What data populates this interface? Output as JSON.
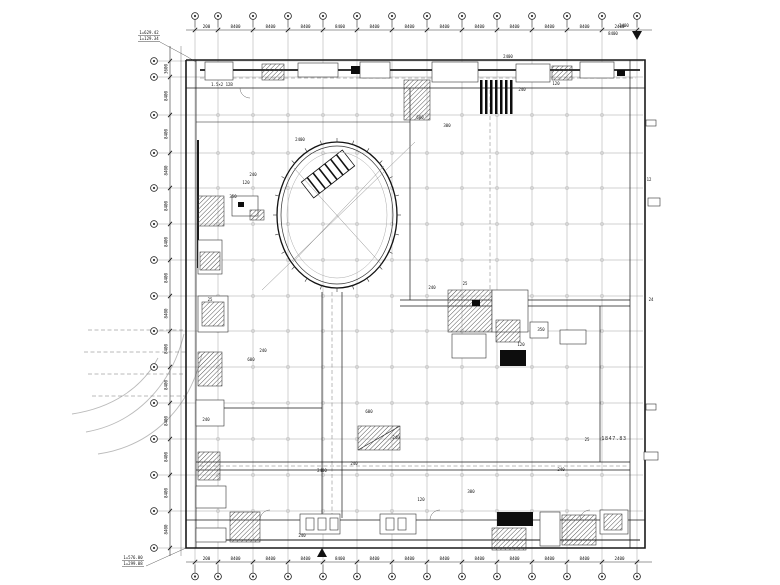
{
  "drawing": {
    "colors": {
      "background": "#ffffff",
      "line": "#111111",
      "wall": "#1a1a1a",
      "grid": "#9a9a9a",
      "dim": "#333333",
      "light": "#bbbbbb",
      "dash": "#777777"
    },
    "grid": {
      "columns_x": [
        195,
        218,
        253,
        288,
        323,
        357,
        392,
        427,
        462,
        497,
        532,
        567,
        602,
        637
      ],
      "rows_y": [
        61,
        77,
        115,
        153,
        188,
        224,
        260,
        296,
        331,
        367,
        403,
        439,
        475,
        511,
        548
      ]
    },
    "dims": {
      "top": [
        "200",
        "8400",
        "8400",
        "8400",
        "8400",
        "8400",
        "8400",
        "8400",
        "8400",
        "8400",
        "8400",
        "8400",
        "2400"
      ],
      "bottom": [
        "200",
        "8400",
        "8400",
        "8400",
        "8400",
        "8400",
        "8400",
        "8400",
        "8400",
        "8400",
        "8400",
        "8400",
        "2400"
      ],
      "left": [
        "3600",
        "8400",
        "8400",
        "8400",
        "8400",
        "8400",
        "8400",
        "8400",
        "8400",
        "8400",
        "8400",
        "8400",
        "8400",
        "8400"
      ]
    },
    "notes": {
      "top_left_line1": "1=629.42",
      "top_left_line2": "1=129.34",
      "bottom_left_line1": "1=576.00",
      "bottom_left_line2": "1=299.08",
      "right_area": "1847.83"
    },
    "atrium": {
      "cx": 337,
      "cy": 215,
      "rx": 60,
      "ry": 73
    },
    "ramp": {
      "x": 302,
      "y": 164,
      "w": 52,
      "h": 20,
      "rot": -38
    },
    "annotations": [
      [
        222,
        86,
        "1.5×2 12B"
      ],
      [
        300,
        141,
        "2400"
      ],
      [
        253,
        176,
        "240"
      ],
      [
        246,
        184,
        "120"
      ],
      [
        233,
        198,
        "350"
      ],
      [
        241,
        206,
        "25"
      ],
      [
        420,
        119,
        "600"
      ],
      [
        447,
        127,
        "300"
      ],
      [
        522,
        91,
        "240"
      ],
      [
        556,
        85,
        "120"
      ],
      [
        432,
        289,
        "240"
      ],
      [
        465,
        285,
        "25"
      ],
      [
        541,
        331,
        "350"
      ],
      [
        521,
        346,
        "120"
      ],
      [
        263,
        352,
        "240"
      ],
      [
        251,
        361,
        "600"
      ],
      [
        210,
        301,
        "25"
      ],
      [
        206,
        421,
        "240"
      ],
      [
        322,
        472,
        "2400"
      ],
      [
        354,
        465,
        "240"
      ],
      [
        421,
        501,
        "120"
      ],
      [
        471,
        493,
        "300"
      ],
      [
        561,
        471,
        "240"
      ],
      [
        587,
        441,
        "25"
      ],
      [
        651,
        301,
        "24"
      ],
      [
        649,
        181,
        "12"
      ],
      [
        369,
        413,
        "600"
      ],
      [
        396,
        439,
        "240"
      ],
      [
        302,
        537,
        "240"
      ],
      [
        508,
        58,
        "2400"
      ],
      [
        624,
        27,
        "2400"
      ],
      [
        613,
        35,
        "8400"
      ]
    ],
    "blocks": [
      [
        205,
        62,
        28,
        18,
        "outline"
      ],
      [
        262,
        64,
        22,
        16,
        "hatch"
      ],
      [
        298,
        63,
        40,
        14,
        "outline"
      ],
      [
        351,
        66,
        10,
        8,
        "solid"
      ],
      [
        360,
        62,
        30,
        16,
        "outline"
      ],
      [
        404,
        80,
        26,
        40,
        "hatch"
      ],
      [
        432,
        62,
        46,
        20,
        "outline"
      ],
      [
        516,
        64,
        34,
        18,
        "outline"
      ],
      [
        552,
        66,
        20,
        14,
        "hatch"
      ],
      [
        580,
        62,
        34,
        16,
        "outline"
      ],
      [
        617,
        70,
        8,
        6,
        "solid"
      ],
      [
        480,
        80,
        2.5,
        34,
        "solid"
      ],
      [
        485,
        80,
        2.5,
        34,
        "solid"
      ],
      [
        490,
        80,
        2.5,
        34,
        "solid"
      ],
      [
        495,
        80,
        2.5,
        34,
        "solid"
      ],
      [
        500,
        80,
        2.5,
        34,
        "solid"
      ],
      [
        505,
        80,
        2.5,
        34,
        "solid"
      ],
      [
        510,
        80,
        2.5,
        34,
        "solid"
      ],
      [
        198,
        196,
        26,
        30,
        "hatch"
      ],
      [
        198,
        240,
        24,
        34,
        "outline"
      ],
      [
        200,
        252,
        20,
        18,
        "hatch"
      ],
      [
        198,
        296,
        30,
        36,
        "outline"
      ],
      [
        202,
        302,
        22,
        24,
        "hatch"
      ],
      [
        198,
        352,
        24,
        34,
        "hatch"
      ],
      [
        196,
        400,
        28,
        26,
        "outline"
      ],
      [
        198,
        452,
        22,
        28,
        "hatch"
      ],
      [
        196,
        486,
        30,
        22,
        "outline"
      ],
      [
        232,
        196,
        26,
        20,
        "outline"
      ],
      [
        238,
        202,
        6,
        5,
        "solid"
      ],
      [
        250,
        210,
        14,
        10,
        "hatch"
      ],
      [
        448,
        290,
        44,
        42,
        "hatch"
      ],
      [
        492,
        290,
        36,
        42,
        "outline"
      ],
      [
        496,
        320,
        24,
        22,
        "hatch"
      ],
      [
        500,
        350,
        26,
        16,
        "solid"
      ],
      [
        530,
        322,
        18,
        16,
        "outline"
      ],
      [
        452,
        334,
        34,
        24,
        "outline"
      ],
      [
        472,
        300,
        8,
        6,
        "solid"
      ],
      [
        560,
        330,
        26,
        14,
        "outline"
      ],
      [
        230,
        512,
        30,
        30,
        "hatch"
      ],
      [
        300,
        514,
        40,
        20,
        "outline"
      ],
      [
        306,
        518,
        8,
        12,
        "outline"
      ],
      [
        318,
        518,
        8,
        12,
        "outline"
      ],
      [
        330,
        518,
        8,
        12,
        "outline"
      ],
      [
        380,
        514,
        36,
        20,
        "outline"
      ],
      [
        386,
        518,
        8,
        12,
        "outline"
      ],
      [
        398,
        518,
        8,
        12,
        "outline"
      ],
      [
        497,
        512,
        36,
        14,
        "solid"
      ],
      [
        492,
        528,
        34,
        22,
        "hatch"
      ],
      [
        540,
        512,
        20,
        34,
        "outline"
      ],
      [
        562,
        515,
        34,
        30,
        "hatch"
      ],
      [
        600,
        510,
        28,
        24,
        "outline"
      ],
      [
        604,
        514,
        18,
        16,
        "hatch"
      ],
      [
        196,
        528,
        30,
        14,
        "outline"
      ],
      [
        358,
        426,
        42,
        24,
        "hatch"
      ],
      [
        646,
        120,
        10,
        6,
        "outline"
      ],
      [
        648,
        198,
        12,
        8,
        "outline"
      ],
      [
        646,
        404,
        10,
        6,
        "outline"
      ],
      [
        644,
        452,
        14,
        8,
        "outline"
      ]
    ],
    "walls": [
      {
        "pts": [
          [
            186,
            60
          ],
          [
            645,
            60
          ],
          [
            645,
            548
          ],
          [
            186,
            548
          ],
          [
            186,
            60
          ]
        ],
        "w": 1.6
      },
      {
        "pts": [
          [
            186,
            88
          ],
          [
            645,
            88
          ]
        ],
        "w": 0.7
      },
      {
        "pts": [
          [
            186,
            520
          ],
          [
            645,
            520
          ]
        ],
        "w": 0.7
      },
      {
        "pts": [
          [
            196,
            60
          ],
          [
            196,
            548
          ]
        ],
        "w": 0.7
      },
      {
        "pts": [
          [
            630,
            60
          ],
          [
            630,
            548
          ]
        ],
        "w": 0.7
      },
      {
        "pts": [
          [
            322,
            292
          ],
          [
            322,
            518
          ]
        ],
        "w": 0.7
      },
      {
        "pts": [
          [
            342,
            292
          ],
          [
            342,
            518
          ]
        ],
        "w": 0.7
      },
      {
        "pts": [
          [
            196,
            462
          ],
          [
            630,
            462
          ]
        ],
        "w": 0.7
      },
      {
        "pts": [
          [
            196,
            470
          ],
          [
            630,
            470
          ]
        ],
        "w": 0.7
      },
      {
        "pts": [
          [
            196,
            408
          ],
          [
            322,
            408
          ]
        ],
        "w": 0.7
      },
      {
        "pts": [
          [
            400,
            300
          ],
          [
            630,
            300
          ]
        ],
        "w": 0.7
      },
      {
        "pts": [
          [
            400,
            306
          ],
          [
            630,
            306
          ]
        ],
        "w": 0.7
      },
      {
        "pts": [
          [
            410,
            88
          ],
          [
            410,
            300
          ]
        ],
        "w": 0.7
      },
      {
        "pts": [
          [
            600,
            306
          ],
          [
            600,
            462
          ]
        ],
        "w": 0.7
      },
      {
        "pts": [
          [
            196,
            122
          ],
          [
            410,
            122
          ]
        ],
        "w": 0.5
      },
      {
        "pts": [
          [
            200,
            70
          ],
          [
            640,
            70
          ]
        ],
        "w": 1.8
      },
      {
        "pts": [
          [
            198,
            140
          ],
          [
            198,
            268
          ]
        ],
        "w": 2.0
      },
      {
        "pts": [
          [
            196,
            540
          ],
          [
            640,
            540
          ]
        ],
        "w": 1.0
      },
      {
        "pts": [
          [
            358,
            450
          ],
          [
            400,
            426
          ]
        ],
        "w": 0.6
      }
    ],
    "dashes": [
      [
        [
          200,
          78
        ],
        [
          636,
          78
        ]
      ],
      [
        [
          332,
          292
        ],
        [
          332,
          518
        ]
      ],
      [
        [
          200,
          466
        ],
        [
          628,
          466
        ]
      ],
      [
        [
          490,
          90
        ],
        [
          490,
          298
        ]
      ],
      [
        [
          88,
          330
        ],
        [
          186,
          330
        ]
      ],
      [
        [
          84,
          352
        ],
        [
          186,
          352
        ]
      ],
      [
        [
          88,
          374
        ],
        [
          186,
          374
        ]
      ],
      [
        [
          92,
          396
        ],
        [
          186,
          396
        ]
      ]
    ],
    "site_arcs": [
      "M 86,432 C 132,424 170,390 184,334",
      "M 98,454 C 152,446 190,408 202,354",
      "M 72,414 C 112,408 142,388 158,358"
    ],
    "door_arcs": [
      "M 260,520 A 10 10 0 0 1 270,510",
      "M 430,520 A 10 10 0 0 1 440,510",
      "M 580,520 A 10 10 0 0 1 590,510",
      "M 240,88 A 10 10 0 0 0 250,98"
    ],
    "leaders": [
      [
        [
          160,
          42
        ],
        [
          186,
          56
        ],
        [
          196,
          62
        ]
      ],
      [
        [
          146,
          566
        ],
        [
          186,
          548
        ]
      ]
    ],
    "triangles": [
      {
        "x": 637,
        "y": 34,
        "dir": "down"
      },
      {
        "x": 322,
        "y": 553,
        "dir": "up"
      }
    ]
  }
}
